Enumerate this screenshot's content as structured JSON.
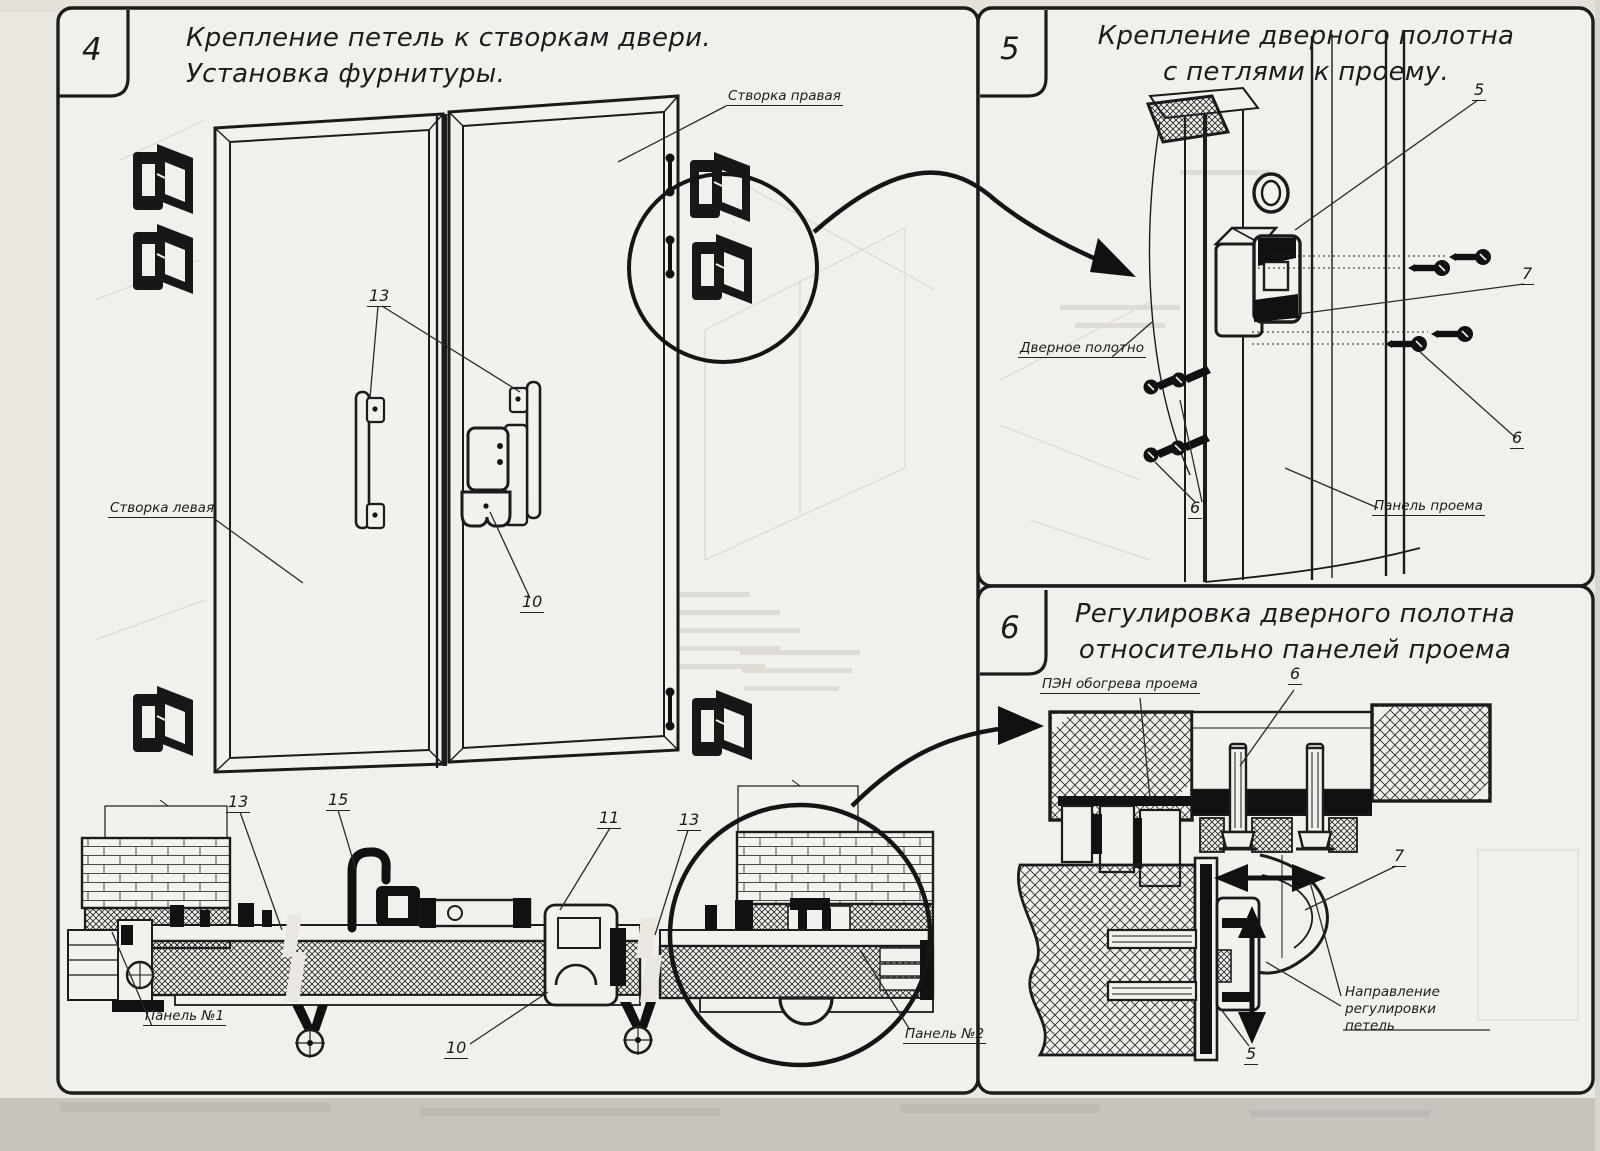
{
  "colors": {
    "ink": "#1c1c1c",
    "paper": "#f2f0ea",
    "page_bg": "#eae7e1",
    "scan_band": "#c7c4be"
  },
  "panel4": {
    "number": "4",
    "title": [
      "Крепление петель к створкам двери.",
      "Установка фурнитуры."
    ],
    "labels": {
      "leaf_right": "Створка правая",
      "leaf_left": "Створка левая",
      "panel_no1": "Панель №1",
      "panel_no2": "Панель №2"
    },
    "callouts": {
      "handles": "13",
      "latch": "10",
      "section_left": "13",
      "hook": "15",
      "lock": "11",
      "section_right": "13",
      "caster": "10"
    }
  },
  "panel5": {
    "number": "5",
    "title": [
      "Крепление дверного полотна",
      "с петлями к проему."
    ],
    "labels": {
      "door_leaf": "Дверное полотно",
      "opening_panel": "Панель проема"
    },
    "callouts": {
      "hinge": "5",
      "plate": "7",
      "screws_right": "6",
      "screws_left": "6"
    }
  },
  "panel6": {
    "number": "6",
    "title": [
      "Регулировка дверного полотна",
      "относительно панелей проема"
    ],
    "labels": {
      "pen_heater": "ПЭН обогрева проема",
      "direction": [
        "Направление регулировки",
        "петель"
      ]
    },
    "callouts": {
      "bolt": "6",
      "hinge_arm": "7",
      "hinge_plate": "5"
    }
  }
}
